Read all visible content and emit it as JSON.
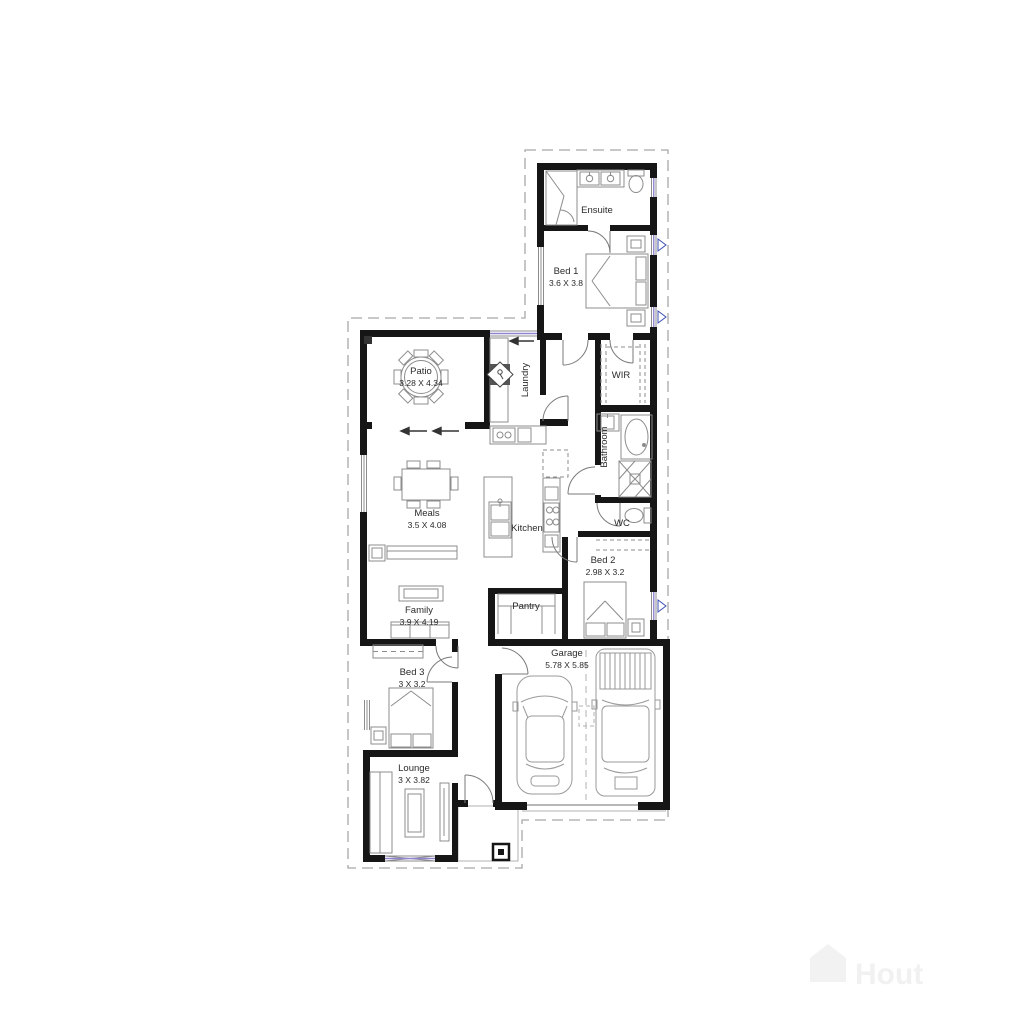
{
  "plan": {
    "title": "Single storey house floor plan",
    "rooms": [
      {
        "id": "ensuite",
        "name": "Ensuite",
        "dims": ""
      },
      {
        "id": "bed1",
        "name": "Bed 1",
        "dims": "3.6 X 3.8"
      },
      {
        "id": "patio",
        "name": "Patio",
        "dims": "3.28 X 4.34"
      },
      {
        "id": "laundry",
        "name": "Laundry",
        "dims": ""
      },
      {
        "id": "wir",
        "name": "WIR",
        "dims": ""
      },
      {
        "id": "bathroom",
        "name": "Bathroom",
        "dims": ""
      },
      {
        "id": "meals",
        "name": "Meals",
        "dims": "3.5 X 4.08"
      },
      {
        "id": "kitchen",
        "name": "Kitchen",
        "dims": ""
      },
      {
        "id": "wc",
        "name": "WC",
        "dims": ""
      },
      {
        "id": "bed2",
        "name": "Bed 2",
        "dims": "2.98 X 3.2"
      },
      {
        "id": "family",
        "name": "Family",
        "dims": "3.9 X 4.19"
      },
      {
        "id": "pantry",
        "name": "Pantry",
        "dims": ""
      },
      {
        "id": "garage",
        "name": "Garage",
        "dims": "5.78 X 5.85"
      },
      {
        "id": "bed3",
        "name": "Bed 3",
        "dims": "3 X 3.2"
      },
      {
        "id": "lounge",
        "name": "Lounge",
        "dims": "3 X 3.82"
      }
    ],
    "watermark": "Hout",
    "colors": {
      "wall": "#161616",
      "furniture_line": "#8c8c8c",
      "glass": "#8f84cf",
      "window_marker": "#3c4fb5",
      "boundary": "#a8a8a8",
      "text": "#2b2b2b"
    }
  }
}
